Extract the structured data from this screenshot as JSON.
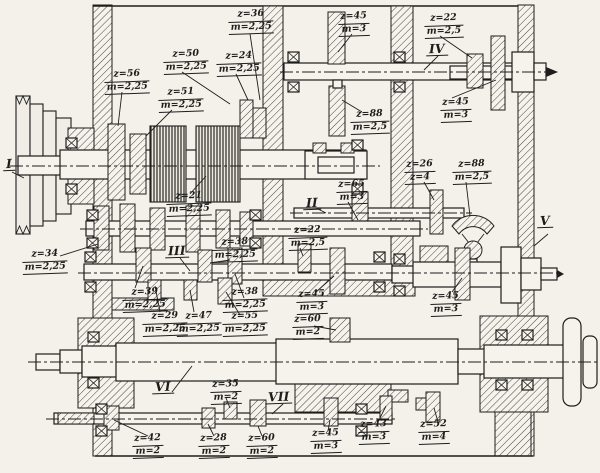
{
  "shaft_labels": [
    "I",
    "II",
    "III",
    "IV",
    "V",
    "VI",
    "VII"
  ],
  "gear_labels": [
    {
      "z": "z=56",
      "m": "m=2,25"
    },
    {
      "z": "z=51",
      "m": "m=2,25"
    },
    {
      "z": "z=50",
      "m": "m=2,25"
    },
    {
      "z": "z=24",
      "m": "m=2,25"
    },
    {
      "z": "z=36",
      "m": "m=2,25"
    },
    {
      "z": "z=45",
      "m": "m=3"
    },
    {
      "z": "z=22",
      "m": "m=2,5"
    },
    {
      "z": "z=88",
      "m": "m=2,5"
    },
    {
      "z": "z=45",
      "m": "m=3"
    },
    {
      "z": "z=21",
      "m": "m=2,25"
    },
    {
      "z": "z=65",
      "m": "m=3"
    },
    {
      "z": "z=26",
      "m": "z=4"
    },
    {
      "z": "z=88",
      "m": "m=2,5"
    },
    {
      "z": "z=22",
      "m": "m=2,5"
    },
    {
      "z": "z=38",
      "m": "m=2,25"
    },
    {
      "z": "z=34",
      "m": "m=2,25"
    },
    {
      "z": "z=39",
      "m": "m=2,25"
    },
    {
      "z": "z=38",
      "m": "m=2,25"
    },
    {
      "z": "z=29",
      "m": "m=2,25"
    },
    {
      "z": "z=47",
      "m": "m=2,25"
    },
    {
      "z": "z=55",
      "m": "m=2,25"
    },
    {
      "z": "z=45",
      "m": "m=3"
    },
    {
      "z": "z=60",
      "m": "m=2"
    },
    {
      "z": "z=45",
      "m": "m=3"
    },
    {
      "z": "z=35",
      "m": "m=2"
    },
    {
      "z": "z=42",
      "m": "m=2"
    },
    {
      "z": "z=28",
      "m": "m=2"
    },
    {
      "z": "z=60",
      "m": "m=2"
    },
    {
      "z": "z=45",
      "m": "m=3"
    },
    {
      "z": "z=43",
      "m": "m=3"
    },
    {
      "z": "z=52",
      "m": "m=4"
    }
  ],
  "colors": {
    "paper": "#f3f1ea",
    "ink": "#1d1d1b"
  }
}
